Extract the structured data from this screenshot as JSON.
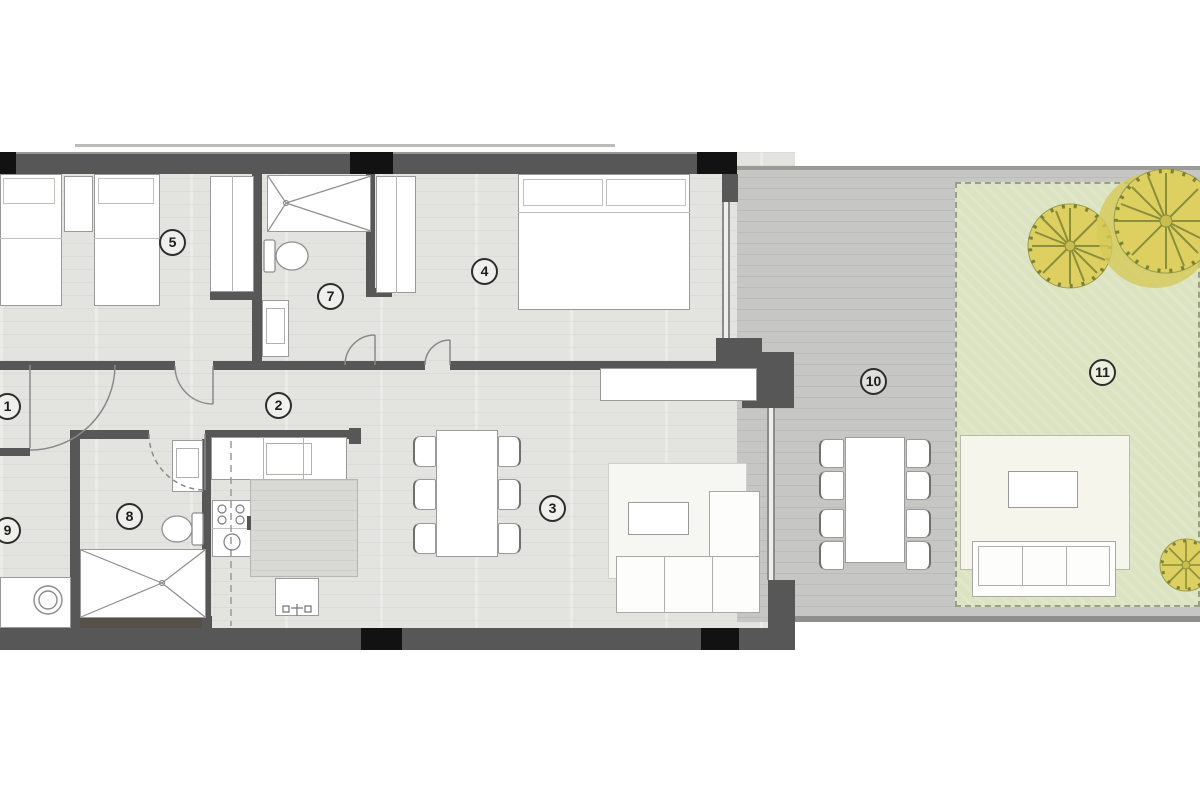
{
  "rooms": [
    {
      "number": "1"
    },
    {
      "number": "2"
    },
    {
      "number": "3"
    },
    {
      "number": "4"
    },
    {
      "number": "5"
    },
    {
      "number": "7"
    },
    {
      "number": "8"
    },
    {
      "number": "9"
    },
    {
      "number": "10"
    },
    {
      "number": "11"
    }
  ],
  "colors": {
    "wall": "#575757",
    "column": "#121212",
    "floor": "#e3e3e0",
    "terrace": "#c6c7c4",
    "garden": "#dce3c2",
    "tree": "#ddcf60",
    "patio": "#f6f5ec",
    "furniture_outline": "#9a9a9a"
  }
}
